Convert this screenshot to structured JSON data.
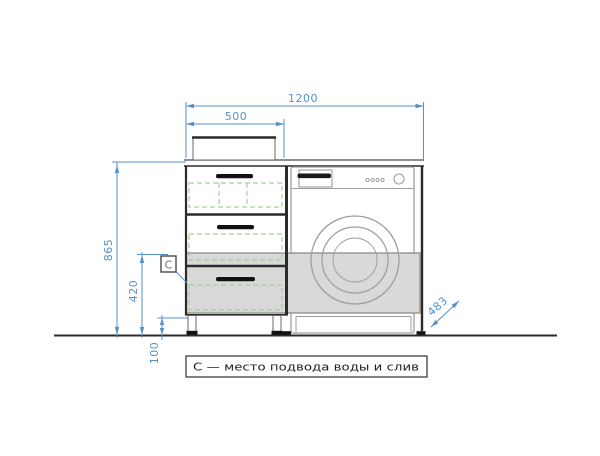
{
  "dimensions": {
    "overall_width": "1200",
    "left_unit_width": "500",
    "total_height": "865",
    "drawer_zone_height": "420",
    "leg_height": "100",
    "diagonal_depth": "483"
  },
  "marker": {
    "label": "С"
  },
  "note": {
    "text": "С — место подвода воды и слив"
  },
  "colors": {
    "dimension_blue": "#5592c9",
    "line_dark": "#2b2b2b",
    "appliance_gray": "#9e9e9e",
    "hidden_green": "#a6ce9b",
    "highlight_fill": "#d9d9d9",
    "highlight_border": "#8c8c8c",
    "background": "#ffffff"
  }
}
